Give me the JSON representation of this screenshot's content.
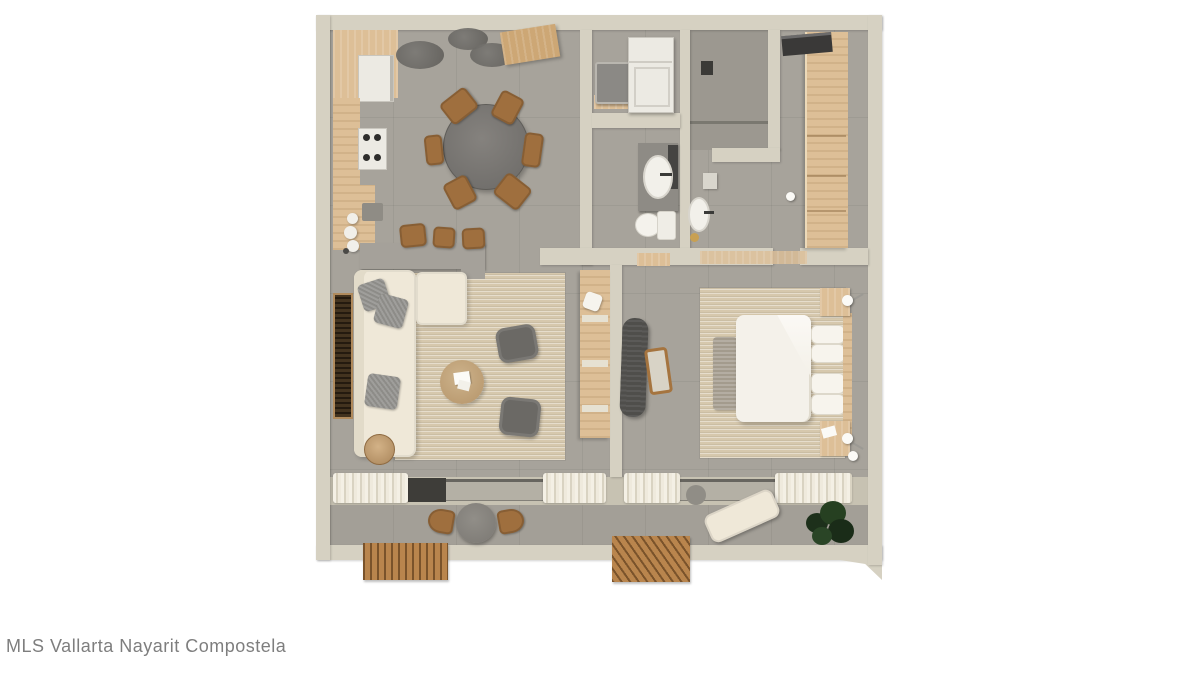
{
  "watermark": "MLS Vallarta Nayarit Compostela",
  "colors": {
    "wall": "#d6d1c2",
    "wallShade": "#c7c2b2",
    "floor": "#a7a39b",
    "floorShower": "#9c9890",
    "terrace": "#a39f97",
    "glass": "#b4b0a5",
    "frameDark": "#3e3d39",
    "wood": "#ddbf97",
    "woodDark": "#cda775",
    "chairWood": "#9f6f3e",
    "counter": "#a5a19a",
    "darkGray": "#6b6965",
    "charcoal": "#4f4e4b",
    "sofa": "#efe8d8",
    "rug": "#d6c8ad",
    "bedWhite": "#f4f1ea",
    "plant": "#22361f",
    "deck": "#b9854d",
    "watermark": "#7e7e7e"
  },
  "plan": {
    "type": "apartment-floor-plan-render",
    "rooms": [
      "kitchen-dining",
      "laundry",
      "bathroom",
      "shower-room",
      "ensuite-bath",
      "walk-in-closet",
      "living-room",
      "bedroom",
      "terrace"
    ]
  }
}
